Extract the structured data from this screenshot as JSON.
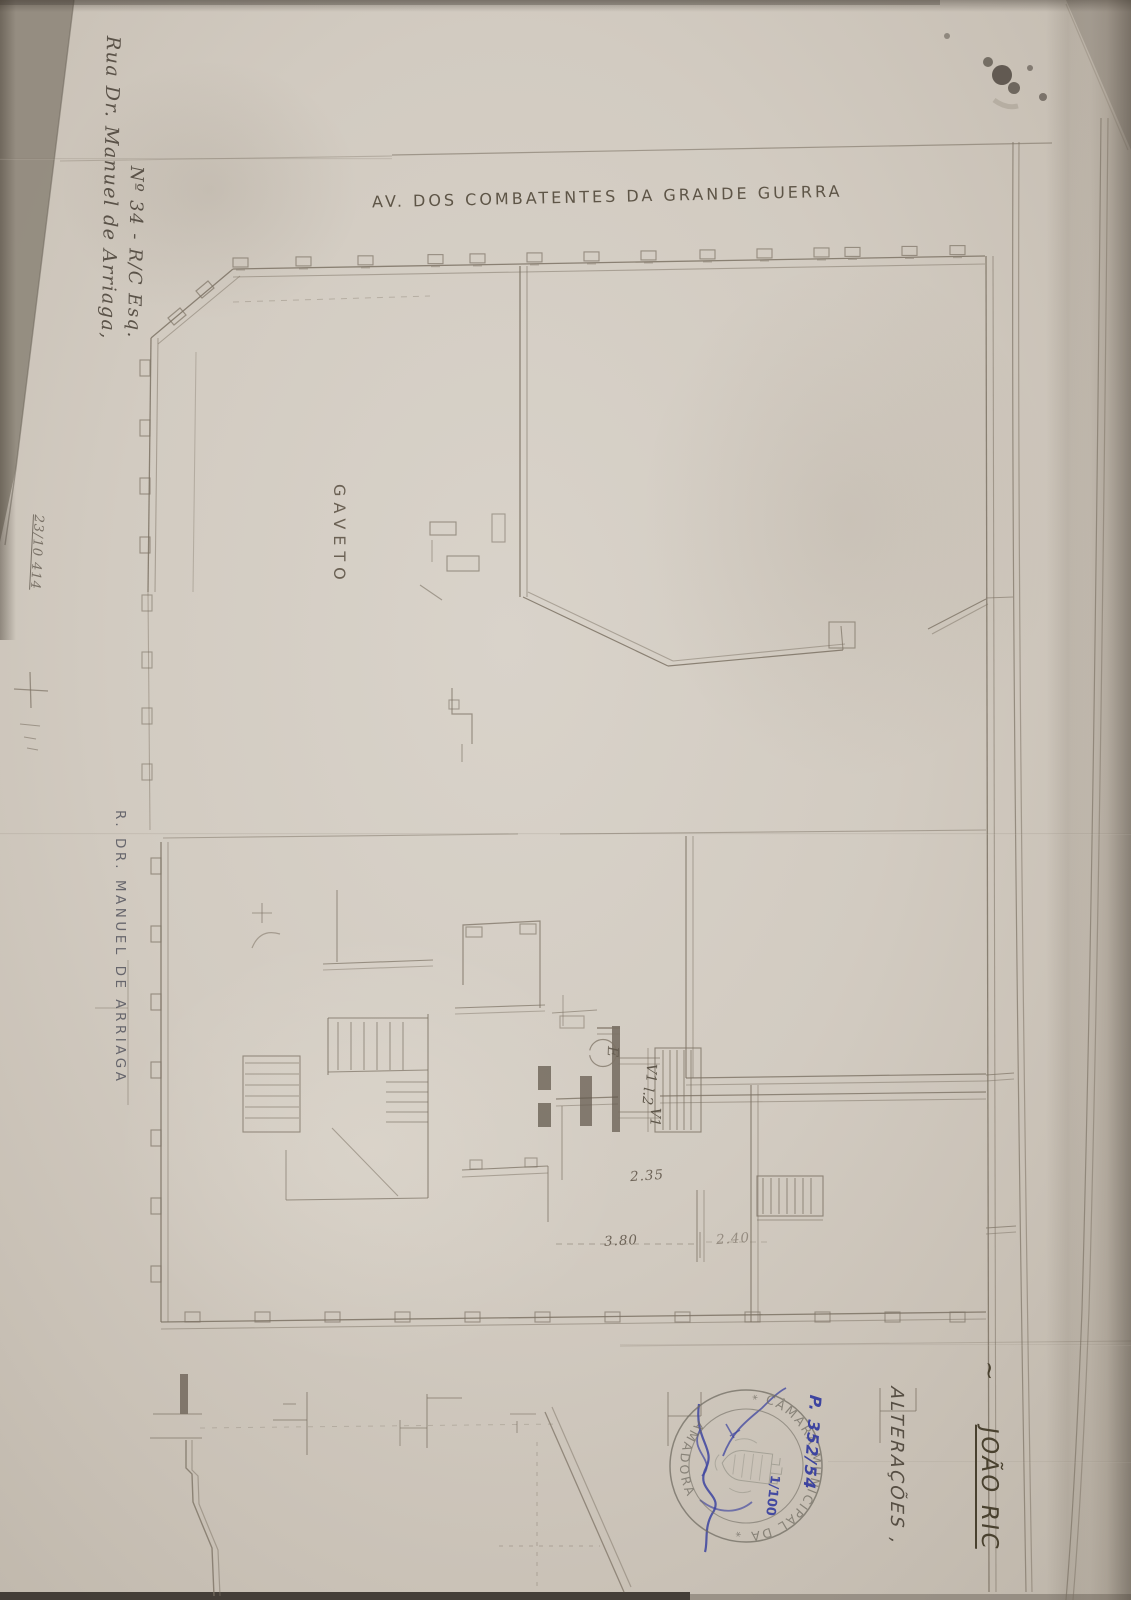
{
  "labels": {
    "street_top": "AV. DOS COMBATENTES DA GRANDE GUERRA",
    "street_left": "R. DR. MANUEL DE ARRIAGA",
    "corner": "GAVETO",
    "address_line1": "Rua Dr. Manuel de Arriaga,",
    "address_line2": "Nº 34 - R/C Esq.",
    "margin_note": "23/10 414",
    "owner_prefix": "~",
    "owner_name": "JOÃO RIC",
    "alterations": "ALTERAÇÕES ,",
    "entrance": "E"
  },
  "dimensions": {
    "hall_width": "2.35",
    "span_left": "3.80",
    "span_right": "2.40"
  },
  "shafts": {
    "v_top": "V1",
    "mid": "l.2",
    "v_bottom": "V1"
  },
  "stamp": {
    "ring_top": "CÂMARA MUNICIPAL DA",
    "ring_bottom": "AMADORA",
    "separator_left": "*",
    "separator_right": "*"
  },
  "blue_annotations": {
    "process_number": "P. 352/54",
    "scale": "1/100"
  },
  "colors": {
    "paper": "#d2cbc1",
    "pencil": "#7d7365",
    "pencil_dark": "#5f564a",
    "stamp_ink": "#6e6a60",
    "pen_blue": "#3d44a0"
  }
}
